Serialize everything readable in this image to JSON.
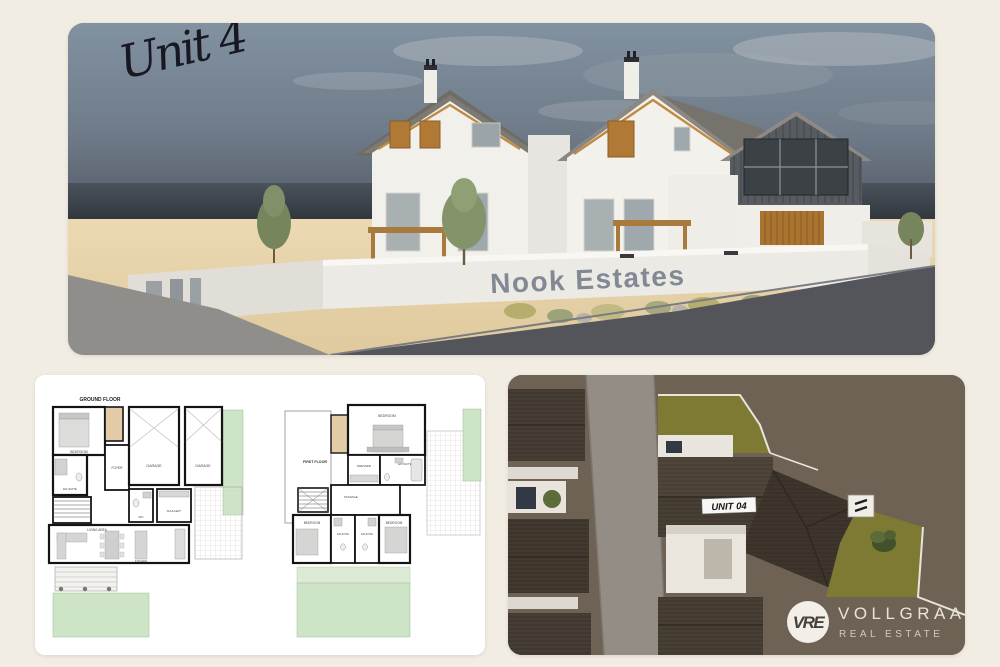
{
  "page": {
    "background_color": "#f2ede3"
  },
  "hero": {
    "handwritten_label": "Unit 4",
    "sign_text": "Nook Estates",
    "colors": {
      "sky_top": "#8292a1",
      "sky_horizon_band": "#3c434a",
      "sand": "#e6d2a8",
      "road": "#55565b",
      "house_white": "#f2f0ea",
      "roof_gray": "#837f79",
      "dark_cladding": "#585c60",
      "timber_accent": "#b07a36"
    }
  },
  "floorplans": {
    "ground_floor": {
      "title": "GROUND FLOOR",
      "rooms": {
        "bedroom": "BEDROOM",
        "en_suite": "EN SUITE",
        "foyer": "FOYER",
        "garage_left": "GARAGE",
        "garage_right": "GARAGE",
        "wc": "WC",
        "scullery": "SCULLERY",
        "living_area": "LIVING AREA",
        "kitchen": "KITCHEN"
      }
    },
    "first_floor": {
      "title": "FIRST FLOOR",
      "rooms": {
        "bedroom_main": "BEDROOM",
        "dresser": "DRESSER",
        "en_suite_main": "EN SUITE",
        "passage": "PASSAGE",
        "bedroom_left": "BEDROOM",
        "en_suite_left": "EN-SUITE",
        "en_suite_right": "EN-SUITE",
        "bedroom_right": "BEDROOM"
      }
    },
    "colors": {
      "lawn": "#cde4c6",
      "walls": "#141414",
      "timber": "#e4cba8",
      "furniture": "#d7d7d5"
    }
  },
  "aerial": {
    "unit_label": "UNIT 04",
    "logo": {
      "monogram": "VRE",
      "name": "VOLLGRAAFF",
      "subtitle": "REAL ESTATE"
    },
    "colors": {
      "ground": "#6e6255",
      "road": "#938d85",
      "roof": "#463d34",
      "lawn": "#7e7a33",
      "boundary_wall": "#e8e4da"
    }
  }
}
